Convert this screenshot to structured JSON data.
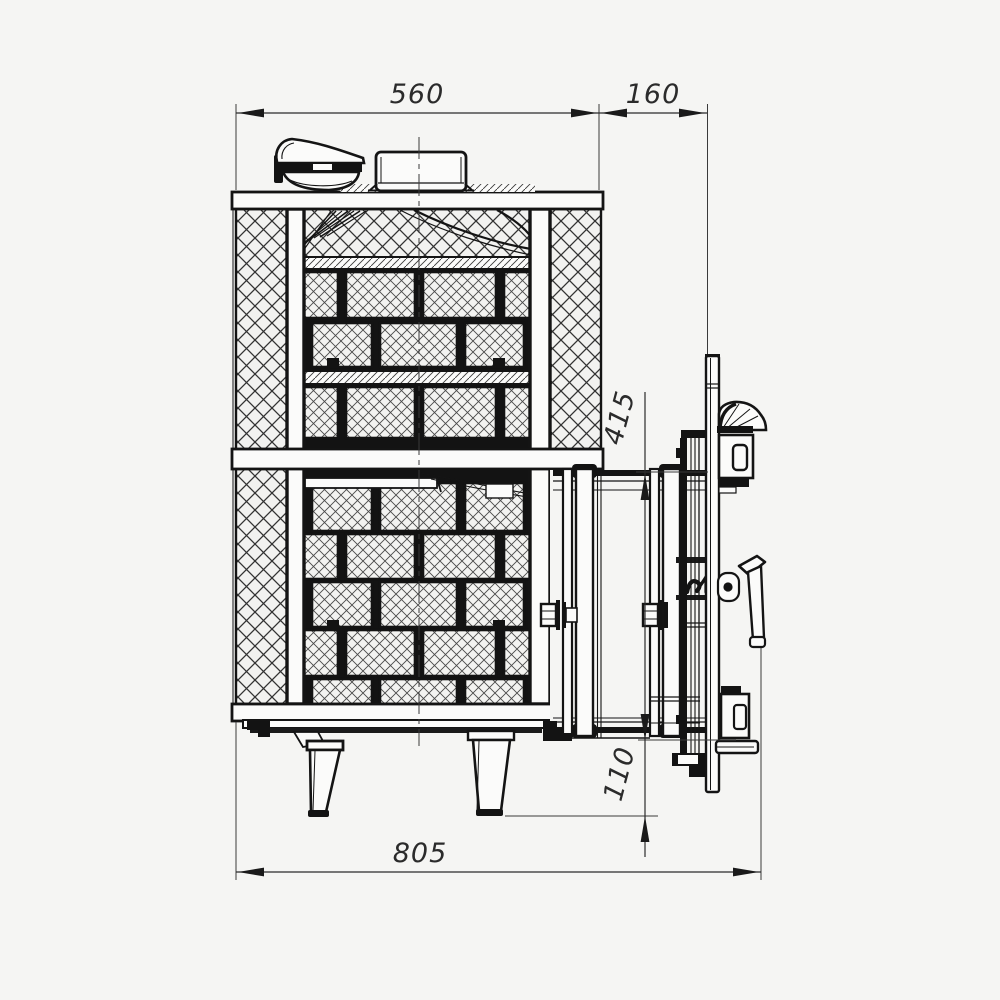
{
  "drawing": {
    "type": "technical-drawing-side-section",
    "subject": "sauna-stove",
    "colors": {
      "background": "#f5f5f3",
      "line": "#141414"
    },
    "dimensions": {
      "width_top": "560",
      "door_offset": "160",
      "tunnel_height": "415",
      "floor_clearance": "110",
      "depth_total": "805"
    }
  }
}
